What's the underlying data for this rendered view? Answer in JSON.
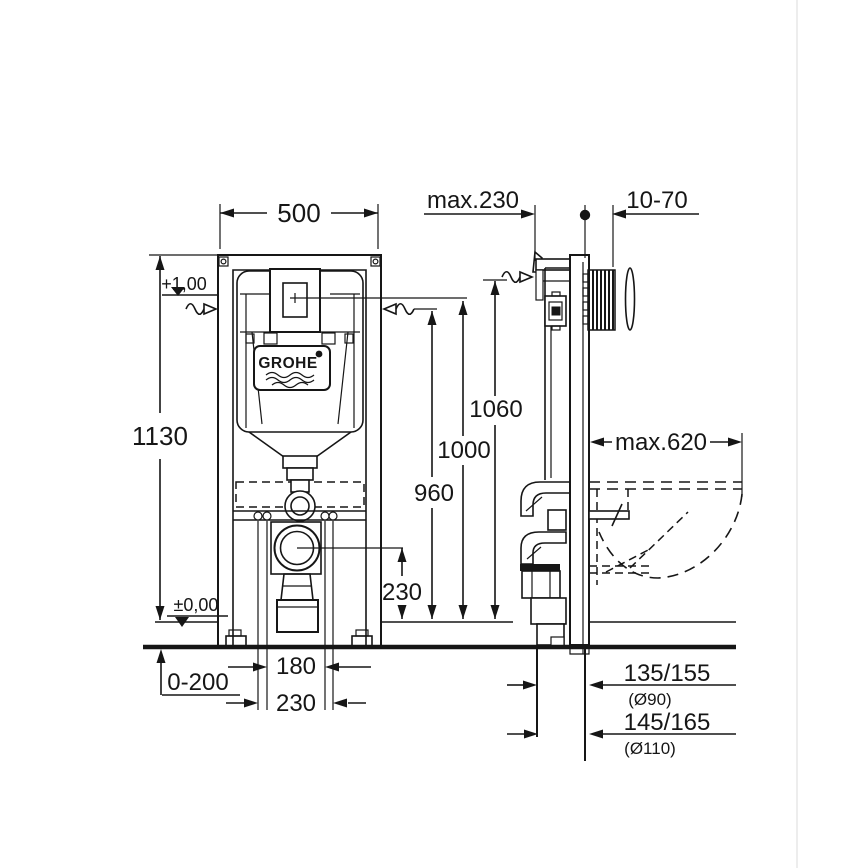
{
  "brand": {
    "logo": "GROHE"
  },
  "front_view": {
    "width": "500",
    "height": "1130",
    "level_top": "+1,00",
    "level_floor": "±0,00",
    "floor_adjust": "0-200",
    "bolt_span_inner": "180",
    "bolt_span_outer": "230",
    "outlet_height": "230"
  },
  "side_view": {
    "wall_clearance": "max.230",
    "plate_depth": "10-70",
    "h_top": "1060",
    "h_plate": "1000",
    "h_wall": "960",
    "bowl_depth": "max.620",
    "drain_90": {
      "offset": "135/155",
      "dia": "(Ø90)"
    },
    "drain_110": {
      "offset": "145/165",
      "dia": "(Ø110)"
    }
  },
  "colors": {
    "line": "#161616",
    "background": "#ffffff"
  }
}
